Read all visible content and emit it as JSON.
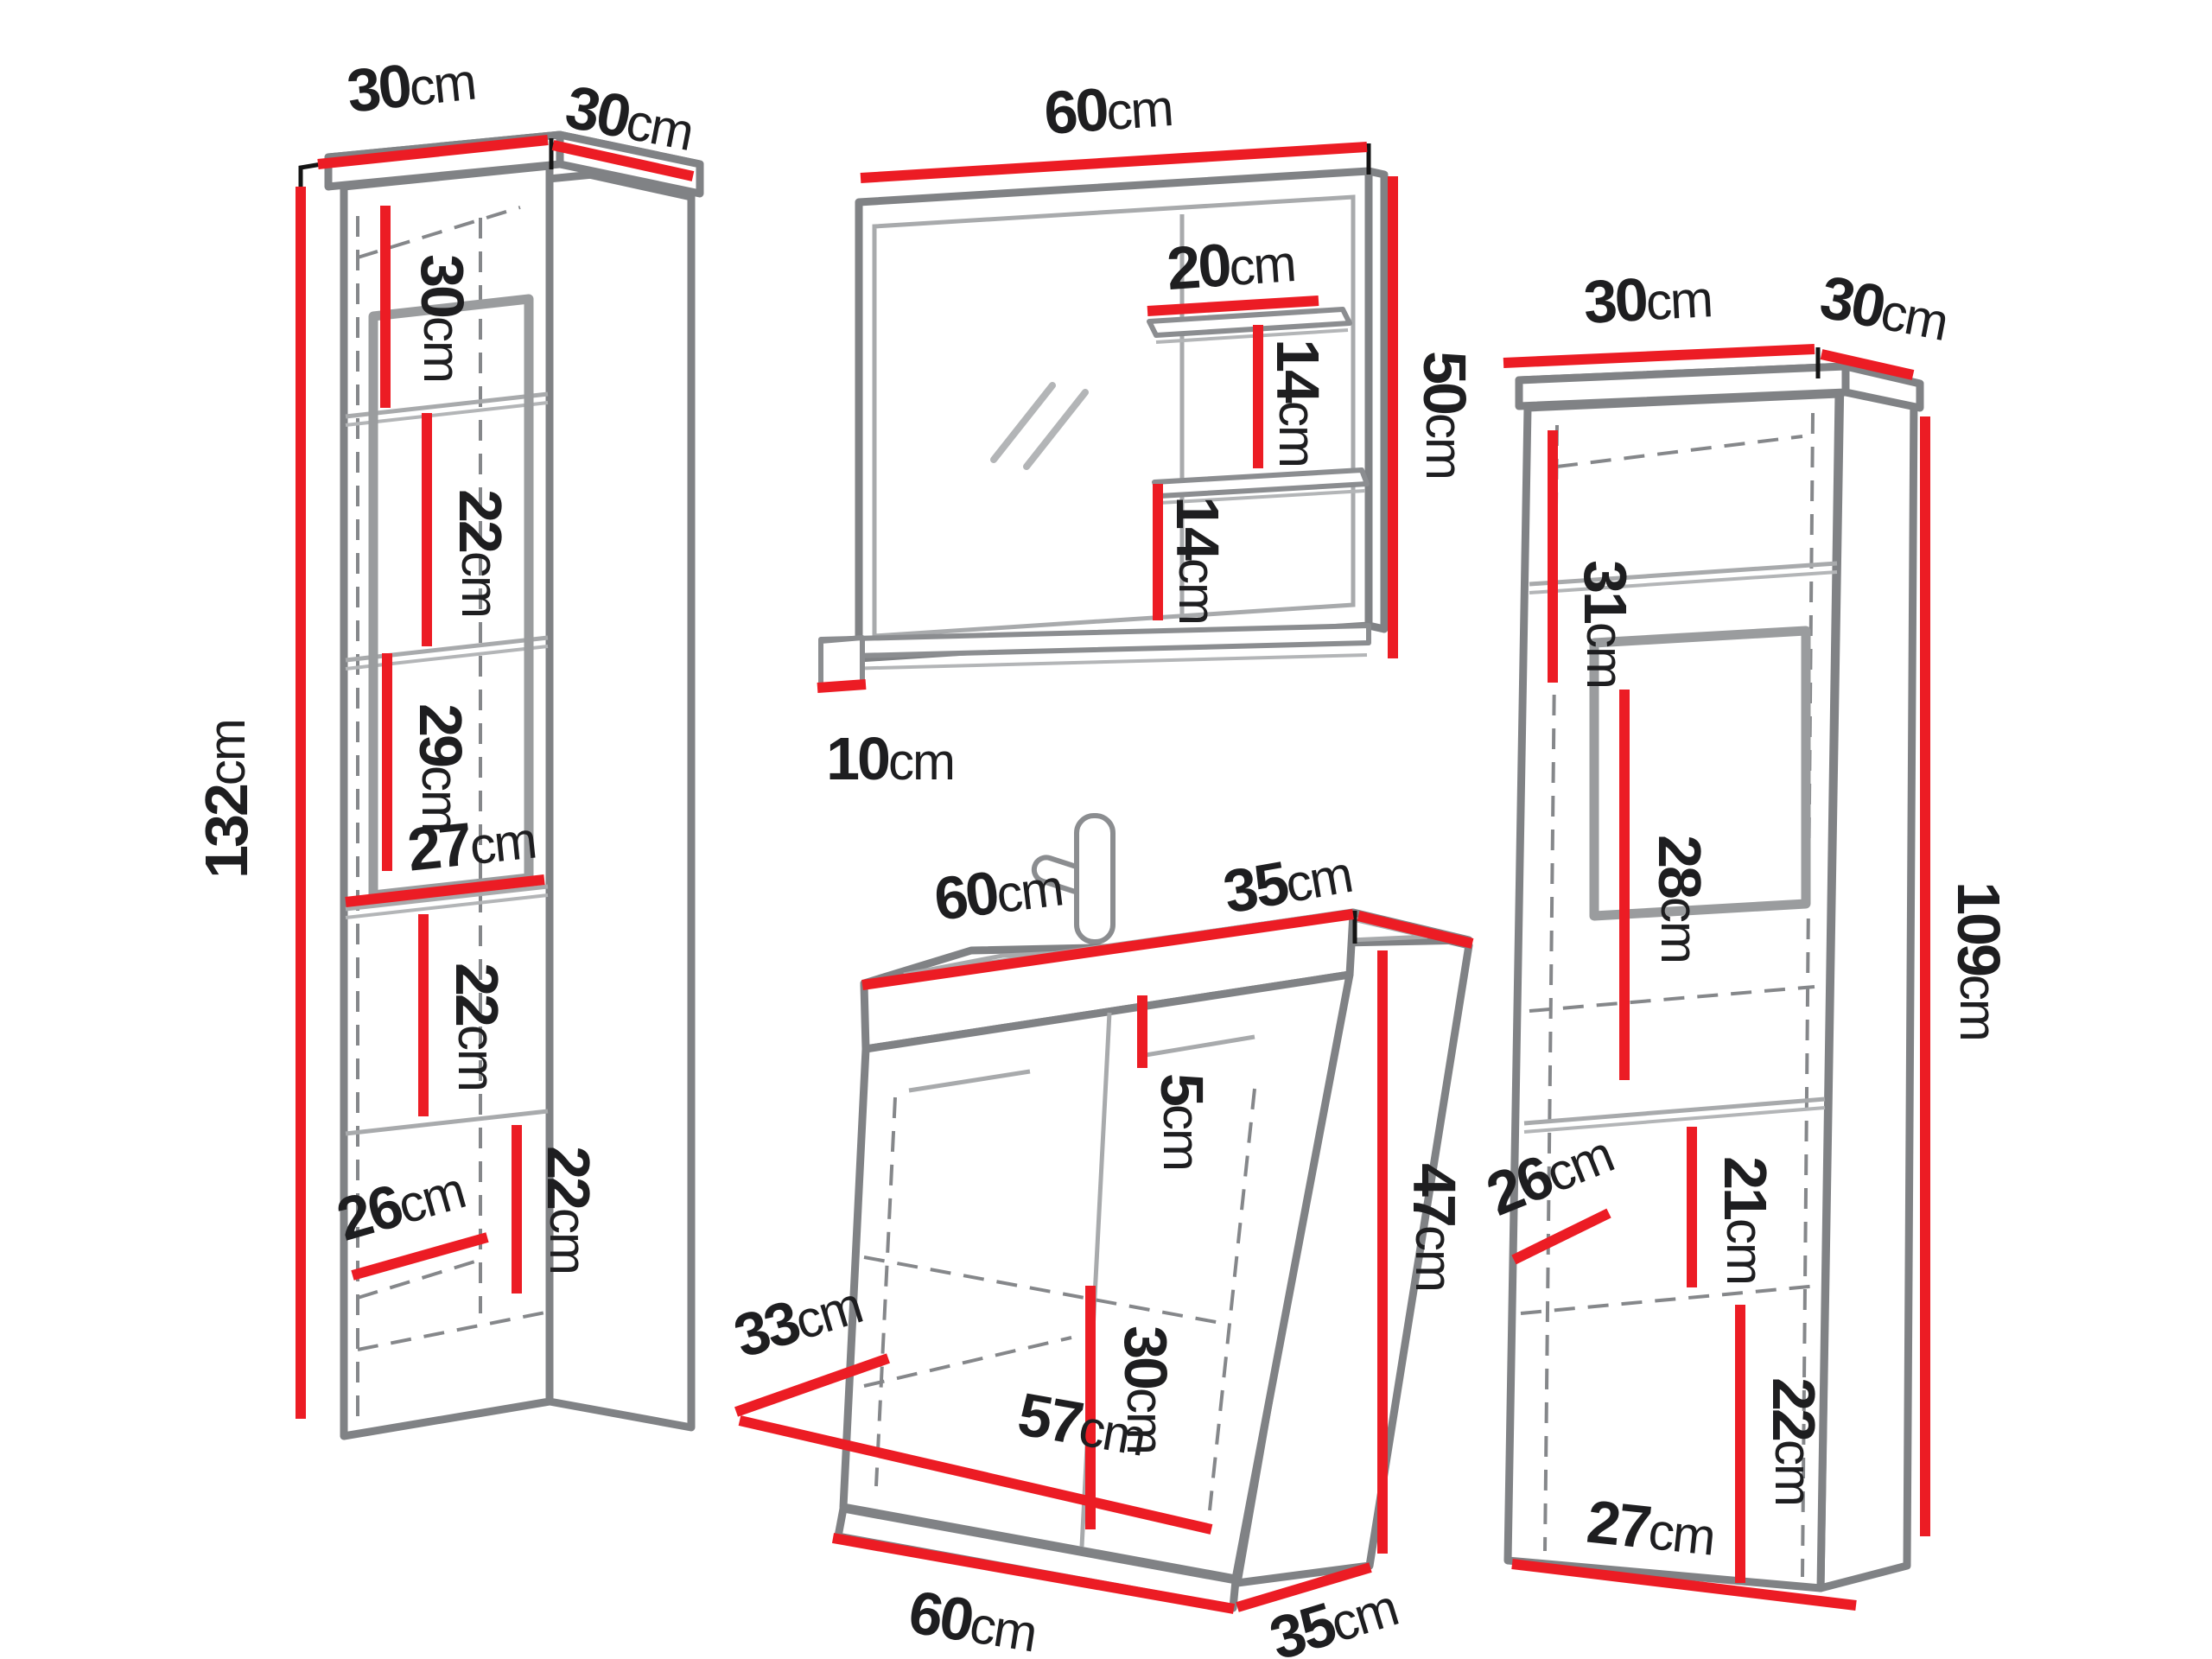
{
  "diagram": {
    "kind": "bathroom furniture set dimension diagram",
    "colors": {
      "dimension_line": "#ec1c24",
      "outline": "#808285",
      "outline_light": "#a8aaac",
      "text": "#1e1e20",
      "background": "#ffffff"
    }
  },
  "labels": {
    "left_cabinet": {
      "top_width": {
        "value": "30",
        "unit": "cm"
      },
      "top_depth": {
        "value": "30",
        "unit": "cm"
      },
      "height": {
        "value": "132",
        "unit": "cm"
      },
      "upper_shelf_gap": {
        "value": "30",
        "unit": "cm"
      },
      "second_shelf_gap": {
        "value": "22",
        "unit": "cm"
      },
      "third_shelf_gap": {
        "value": "29",
        "unit": "cm"
      },
      "inner_width": {
        "value": "27",
        "unit": "cm"
      },
      "fourth_shelf_gap": {
        "value": "22",
        "unit": "cm"
      },
      "inner_depth": {
        "value": "26",
        "unit": "cm"
      },
      "bottom_shelf_gap": {
        "value": "22",
        "unit": "cm"
      }
    },
    "mirror": {
      "width": {
        "value": "60",
        "unit": "cm"
      },
      "shelf_width": {
        "value": "20",
        "unit": "cm"
      },
      "upper_shelf_gap": {
        "value": "14",
        "unit": "cm"
      },
      "lower_shelf_gap": {
        "value": "14",
        "unit": "cm"
      },
      "height": {
        "value": "50",
        "unit": "cm"
      },
      "ledge_depth": {
        "value": "10",
        "unit": "cm"
      }
    },
    "vanity": {
      "top_width": {
        "value": "60",
        "unit": "cm"
      },
      "top_depth": {
        "value": "35",
        "unit": "cm"
      },
      "basin_height": {
        "value": "5",
        "unit": "cm"
      },
      "body_height": {
        "value": "47",
        "unit": "cm"
      },
      "door_height": {
        "value": "30",
        "unit": "cm"
      },
      "inner_depth": {
        "value": "33",
        "unit": "cm"
      },
      "inner_width": {
        "value": "57",
        "unit": "cm"
      },
      "bottom_width": {
        "value": "60",
        "unit": "cm"
      },
      "bottom_depth": {
        "value": "35",
        "unit": "cm"
      }
    },
    "right_cabinet": {
      "top_width": {
        "value": "30",
        "unit": "cm"
      },
      "top_depth": {
        "value": "30",
        "unit": "cm"
      },
      "height": {
        "value": "109",
        "unit": "cm"
      },
      "upper_shelf_gap": {
        "value": "31",
        "unit": "cm"
      },
      "glass_section": {
        "value": "28",
        "unit": "cm"
      },
      "middle_shelf_gap": {
        "value": "21",
        "unit": "cm"
      },
      "inner_depth": {
        "value": "26",
        "unit": "cm"
      },
      "bottom_shelf_gap": {
        "value": "22",
        "unit": "cm"
      },
      "bottom_width": {
        "value": "27",
        "unit": "cm"
      }
    }
  }
}
